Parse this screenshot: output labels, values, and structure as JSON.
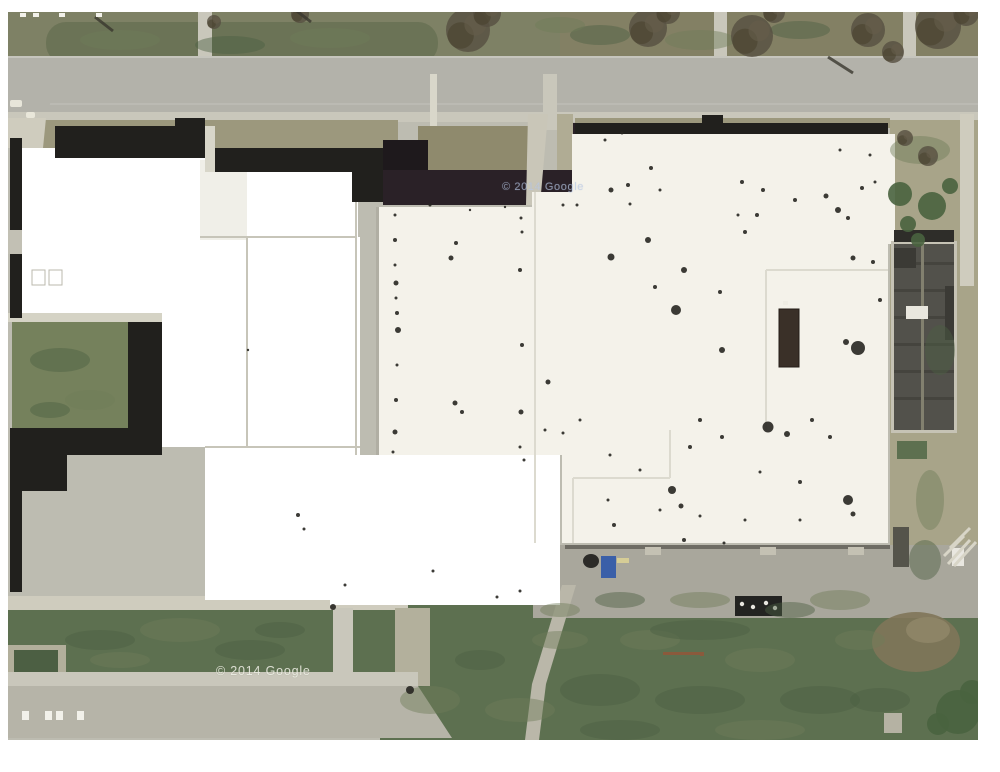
{
  "map": {
    "type": "satellite-aerial-view",
    "description": "overhead aerial photo of a large school building complex with white and dark roofs, roads, lawns and parking"
  },
  "watermarks": {
    "center": "© 2014 Google",
    "bottom": "© 2014 Google"
  },
  "palette": {
    "margin": "#ffffff",
    "pave": "#bdbcb1",
    "road": "#b3b2aa",
    "roadLight": "#c9c7bb",
    "sidewalk": "#cfccbe",
    "verge": "#9c987d",
    "grassTop": "#7e8165",
    "grassTopRight": "#838064",
    "median": "#6b7356",
    "lawn": "#5d7050",
    "lawnDark": "#4c5f43",
    "courtyard": "#75815c",
    "maskWhite": "#ffffff",
    "roofWhite": "#f4f2ea",
    "roofDark": "#21201d",
    "maroon": "#2a2127",
    "gable": "#52514b",
    "gableLight": "#82806f",
    "gableDark": "#3b3a35",
    "tanRight": "#a8a489",
    "dirt": "#7f7659",
    "apron": "#a9a79c",
    "tree": "#564f41",
    "bush": "#49633f",
    "blueBin": "#3a5fa8",
    "rust": "#8a5a3c",
    "speck": "#272621"
  },
  "features": {
    "roof_specks": [
      [
        395,
        215,
        1.5
      ],
      [
        395,
        240,
        2
      ],
      [
        395,
        265,
        1.5
      ],
      [
        396,
        283,
        2.5
      ],
      [
        396,
        298,
        1.5
      ],
      [
        397,
        313,
        2
      ],
      [
        398,
        330,
        3
      ],
      [
        397,
        365,
        1.5
      ],
      [
        396,
        400,
        2
      ],
      [
        395,
        432,
        2.5
      ],
      [
        393,
        452,
        1.5
      ],
      [
        521,
        218,
        1.5
      ],
      [
        522,
        232,
        1.5
      ],
      [
        520,
        270,
        2
      ],
      [
        522,
        345,
        2
      ],
      [
        521,
        412,
        2.5
      ],
      [
        520,
        447,
        1.5
      ],
      [
        524,
        460,
        1.5
      ],
      [
        451,
        258,
        2.5
      ],
      [
        455,
        403,
        2.5
      ],
      [
        548,
        382,
        2.5
      ],
      [
        456,
        243,
        2
      ],
      [
        462,
        412,
        2
      ],
      [
        545,
        430,
        1.5
      ],
      [
        430,
        205,
        1.5
      ],
      [
        470,
        210,
        1.2
      ],
      [
        505,
        207,
        1.2
      ],
      [
        563,
        205,
        1.5
      ],
      [
        577,
        205,
        1.5
      ],
      [
        605,
        140,
        1.5
      ],
      [
        622,
        133,
        1.5
      ],
      [
        630,
        204,
        1.5
      ],
      [
        660,
        190,
        1.5
      ],
      [
        651,
        168,
        2
      ],
      [
        611,
        190,
        2.5
      ],
      [
        628,
        185,
        2
      ],
      [
        742,
        182,
        2
      ],
      [
        763,
        190,
        2
      ],
      [
        795,
        200,
        2
      ],
      [
        826,
        196,
        2.5
      ],
      [
        838,
        210,
        3
      ],
      [
        848,
        218,
        2
      ],
      [
        862,
        188,
        2
      ],
      [
        875,
        182,
        1.5
      ],
      [
        870,
        155,
        1.5
      ],
      [
        840,
        150,
        1.5
      ],
      [
        757,
        215,
        2
      ],
      [
        745,
        232,
        2
      ],
      [
        738,
        215,
        1.5
      ],
      [
        853,
        258,
        2.5
      ],
      [
        873,
        262,
        2
      ],
      [
        880,
        300,
        2
      ],
      [
        648,
        240,
        3
      ],
      [
        611,
        257,
        3.5
      ],
      [
        684,
        270,
        3
      ],
      [
        655,
        287,
        2
      ],
      [
        676,
        310,
        5
      ],
      [
        720,
        292,
        2
      ],
      [
        722,
        350,
        3
      ],
      [
        700,
        420,
        2
      ],
      [
        690,
        447,
        2
      ],
      [
        722,
        437,
        2
      ],
      [
        812,
        420,
        2
      ],
      [
        830,
        437,
        2
      ],
      [
        800,
        482,
        2
      ],
      [
        760,
        472,
        1.5
      ],
      [
        640,
        470,
        1.5
      ],
      [
        610,
        455,
        1.5
      ],
      [
        580,
        420,
        1.5
      ],
      [
        563,
        433,
        1.5
      ],
      [
        672,
        490,
        4
      ],
      [
        681,
        506,
        2.5
      ],
      [
        846,
        342,
        3
      ],
      [
        858,
        348,
        7
      ],
      [
        768,
        427,
        5.5
      ],
      [
        787,
        434,
        3
      ],
      [
        848,
        500,
        5
      ],
      [
        853,
        514,
        2.5
      ],
      [
        614,
        525,
        2
      ],
      [
        660,
        510,
        1.5
      ],
      [
        700,
        516,
        1.5
      ],
      [
        745,
        520,
        1.5
      ],
      [
        800,
        520,
        1.5
      ],
      [
        684,
        540,
        2
      ],
      [
        724,
        543,
        1.5
      ],
      [
        608,
        500,
        1.5
      ],
      [
        298,
        515,
        2
      ],
      [
        304,
        529,
        1.5
      ],
      [
        345,
        585,
        1.5
      ],
      [
        497,
        597,
        1.5
      ],
      [
        520,
        591,
        1.5
      ],
      [
        433,
        571,
        1.5
      ],
      [
        248,
        350,
        1.2
      ],
      [
        333,
        607,
        3
      ],
      [
        410,
        690,
        4
      ]
    ],
    "trees": [
      [
        214,
        22,
        7
      ],
      [
        300,
        14,
        9
      ],
      [
        468,
        30,
        22
      ],
      [
        487,
        13,
        14
      ],
      [
        648,
        28,
        19
      ],
      [
        668,
        12,
        12
      ],
      [
        752,
        36,
        21
      ],
      [
        774,
        12,
        11
      ],
      [
        868,
        30,
        17
      ],
      [
        893,
        52,
        11
      ],
      [
        938,
        26,
        23
      ],
      [
        966,
        13,
        13
      ],
      [
        928,
        156,
        10
      ],
      [
        905,
        138,
        8
      ]
    ],
    "bushes": [
      [
        900,
        194,
        12
      ],
      [
        932,
        206,
        14
      ],
      [
        950,
        186,
        8
      ],
      [
        908,
        224,
        8
      ],
      [
        918,
        240,
        7
      ],
      [
        958,
        712,
        22
      ],
      [
        972,
        692,
        12
      ],
      [
        938,
        724,
        11
      ]
    ],
    "lawn_texture": [
      [
        430,
        700,
        30,
        14
      ],
      [
        480,
        660,
        25,
        10
      ],
      [
        520,
        710,
        35,
        12
      ],
      [
        600,
        690,
        40,
        16
      ],
      [
        650,
        640,
        30,
        10
      ],
      [
        700,
        700,
        45,
        14
      ],
      [
        760,
        660,
        35,
        12
      ],
      [
        820,
        700,
        40,
        14
      ],
      [
        860,
        640,
        25,
        10
      ],
      [
        700,
        630,
        50,
        10
      ],
      [
        560,
        640,
        28,
        9
      ],
      [
        620,
        730,
        40,
        10
      ],
      [
        760,
        730,
        45,
        10
      ],
      [
        880,
        700,
        30,
        12
      ],
      [
        840,
        600,
        30,
        10
      ],
      [
        790,
        610,
        25,
        8
      ],
      [
        700,
        600,
        30,
        8
      ],
      [
        620,
        600,
        25,
        8
      ],
      [
        560,
        610,
        20,
        7
      ],
      [
        100,
        640,
        35,
        10
      ],
      [
        180,
        630,
        40,
        12
      ],
      [
        250,
        650,
        35,
        10
      ],
      [
        120,
        660,
        30,
        8
      ],
      [
        280,
        630,
        25,
        8
      ],
      [
        120,
        40,
        40,
        10
      ],
      [
        230,
        45,
        35,
        9
      ],
      [
        330,
        38,
        40,
        10
      ],
      [
        600,
        35,
        30,
        10
      ],
      [
        700,
        40,
        35,
        10
      ],
      [
        800,
        30,
        30,
        9
      ],
      [
        560,
        25,
        25,
        8
      ],
      [
        60,
        360,
        30,
        12
      ],
      [
        90,
        400,
        25,
        10
      ],
      [
        50,
        410,
        20,
        8
      ],
      [
        920,
        150,
        30,
        14
      ],
      [
        940,
        350,
        15,
        25
      ],
      [
        930,
        500,
        14,
        30
      ],
      [
        925,
        560,
        16,
        20
      ]
    ],
    "pole_shadows": [
      [
        95,
        17,
        113,
        31
      ],
      [
        293,
        8,
        311,
        22
      ],
      [
        828,
        57,
        853,
        73
      ]
    ],
    "hatch_lines": [
      [
        948,
        564,
        970,
        540
      ],
      [
        954,
        566,
        976,
        542
      ],
      [
        944,
        556,
        964,
        536
      ],
      [
        950,
        548,
        970,
        528
      ]
    ],
    "parking_dashes_bottom": [
      [
        22,
        711
      ],
      [
        45,
        711
      ],
      [
        56,
        711
      ],
      [
        77,
        711
      ]
    ],
    "parking_dashes_top": [
      [
        20,
        13
      ],
      [
        33,
        13
      ],
      [
        59,
        13
      ],
      [
        96,
        13
      ]
    ],
    "apron_pads": [
      [
        645,
        547
      ],
      [
        760,
        547
      ],
      [
        848,
        547
      ]
    ],
    "white_curbs": [
      [
        10,
        100,
        12,
        7
      ],
      [
        26,
        112,
        9,
        6
      ]
    ]
  }
}
